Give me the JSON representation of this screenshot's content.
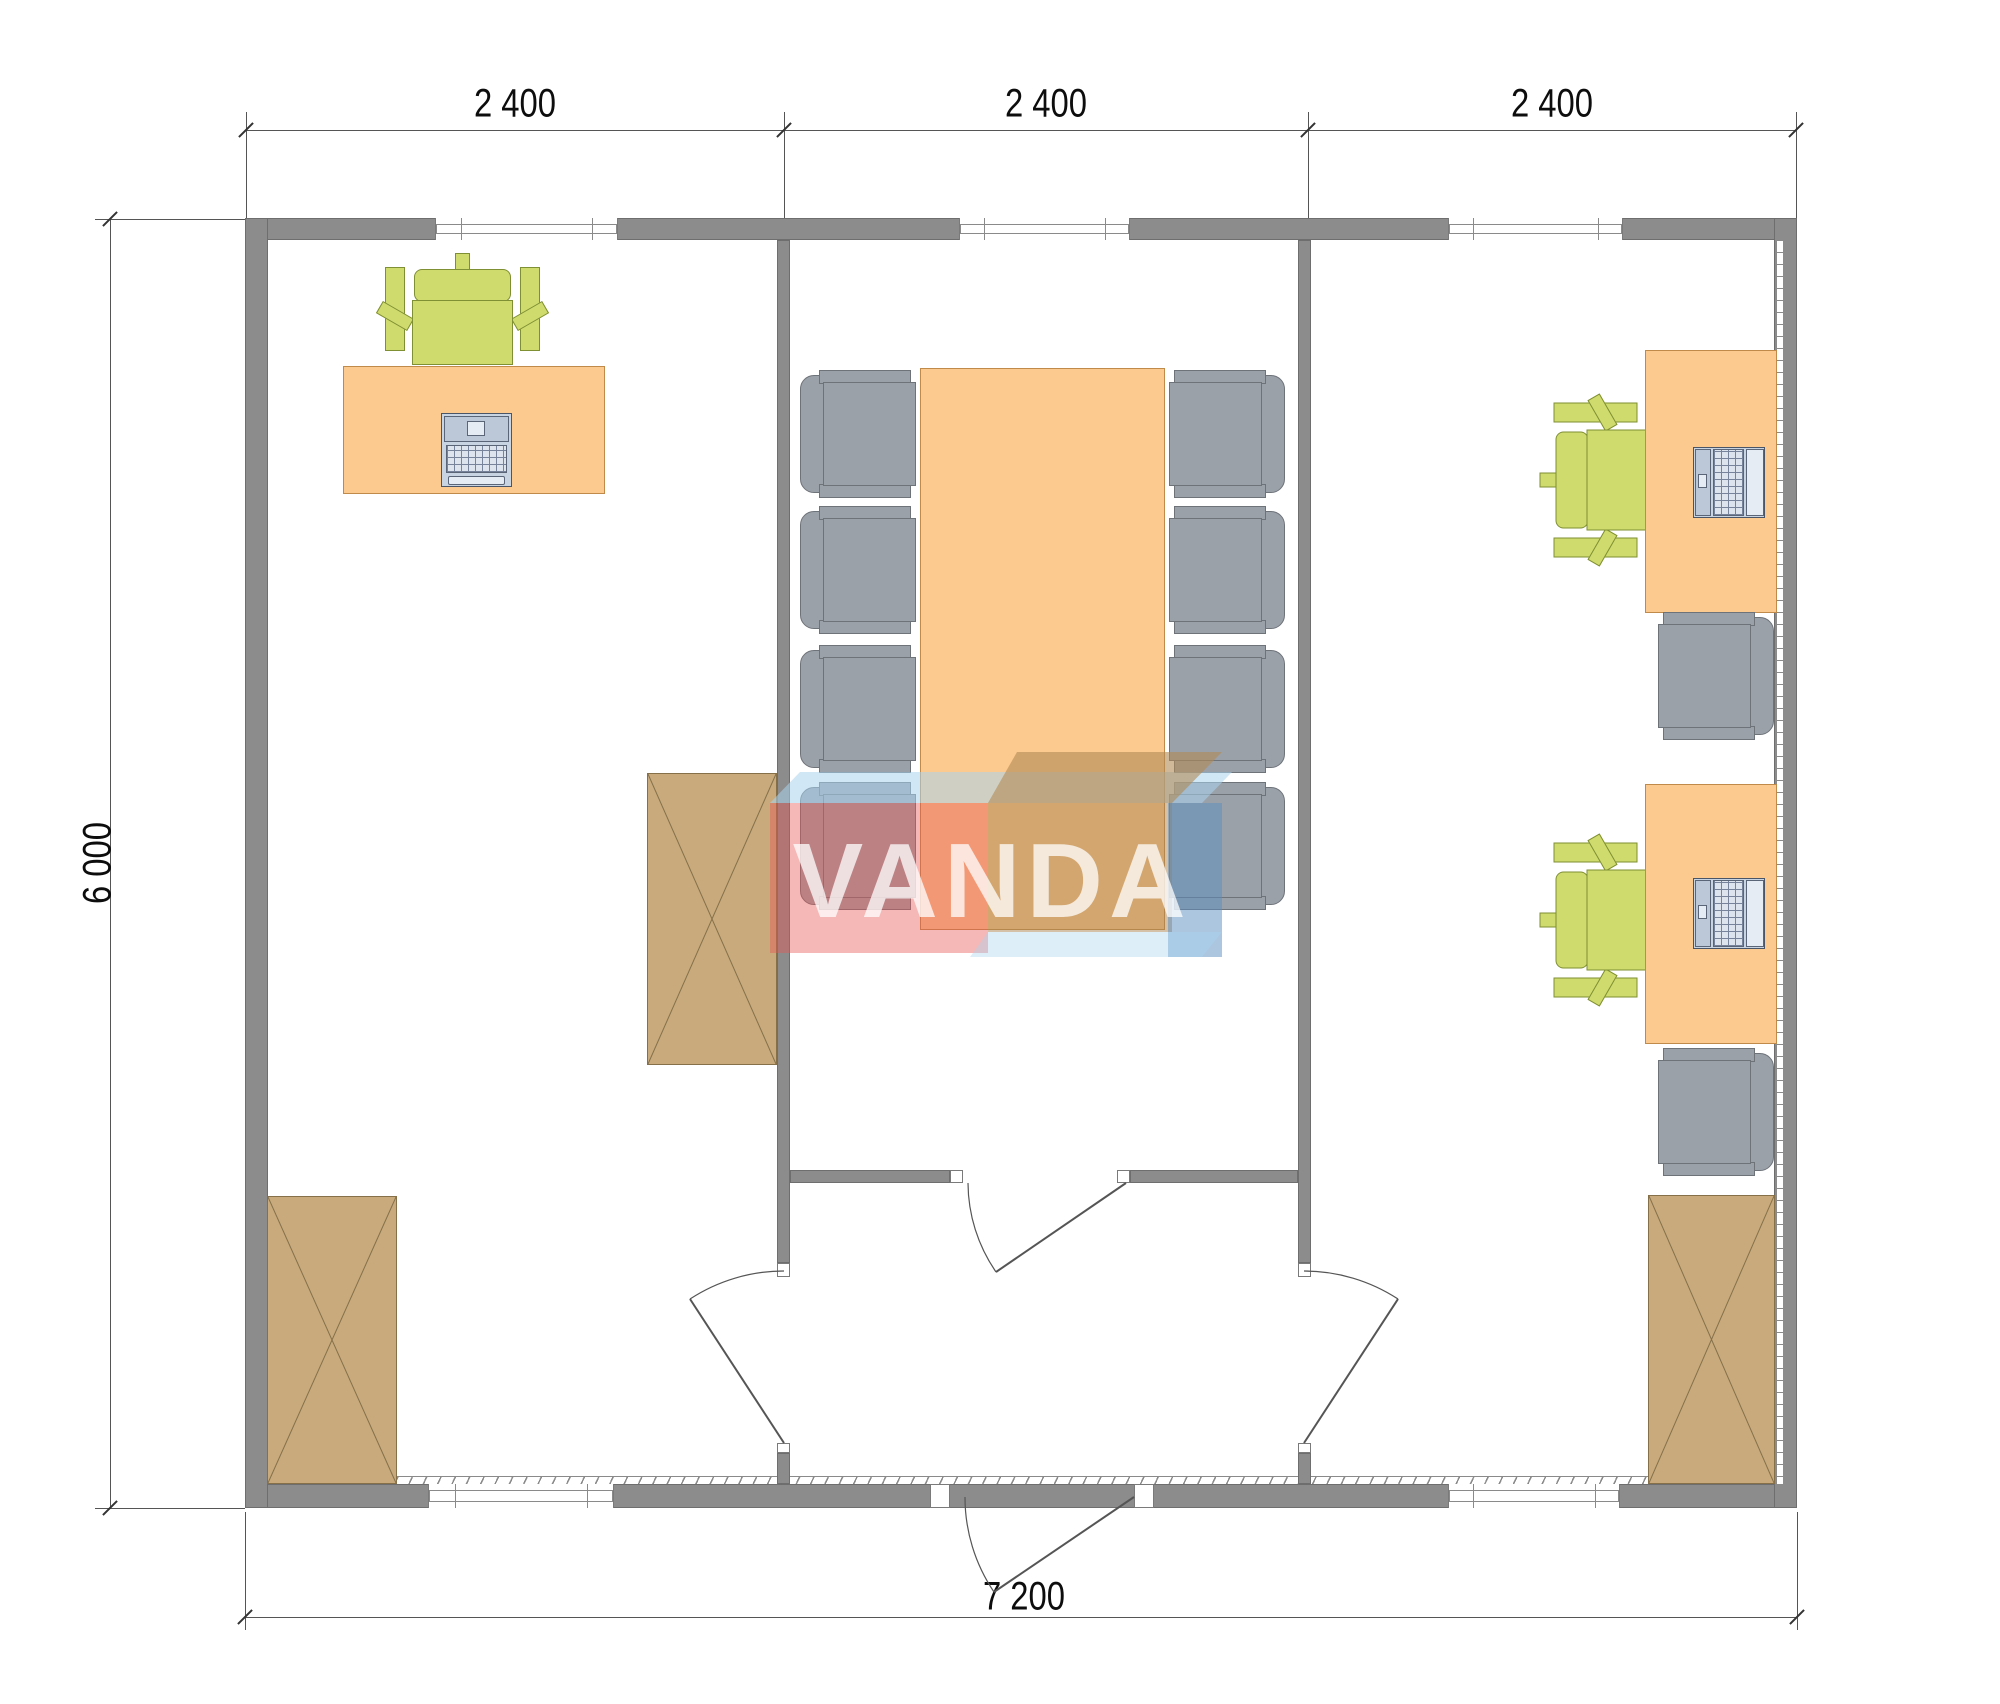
{
  "watermark": {
    "text": "VANDA"
  },
  "dimensions": {
    "top": [
      {
        "label": "2 400"
      },
      {
        "label": "2 400"
      },
      {
        "label": "2 400"
      }
    ],
    "left": {
      "label": "6 000"
    },
    "bottom": {
      "label": "7 200"
    }
  },
  "colors": {
    "wall": "#8c8c8c",
    "desk_top": "#fcc98f",
    "office_chair_green": "#cfdb6d",
    "task_chair_gray": "#9ba1a8",
    "cabinet_wood": "#c8aa7c",
    "logo_red": "#e85550",
    "logo_blue": "#5a8ec0",
    "logo_light_blue": "#aad4ef",
    "logo_tan": "#a9834f"
  }
}
